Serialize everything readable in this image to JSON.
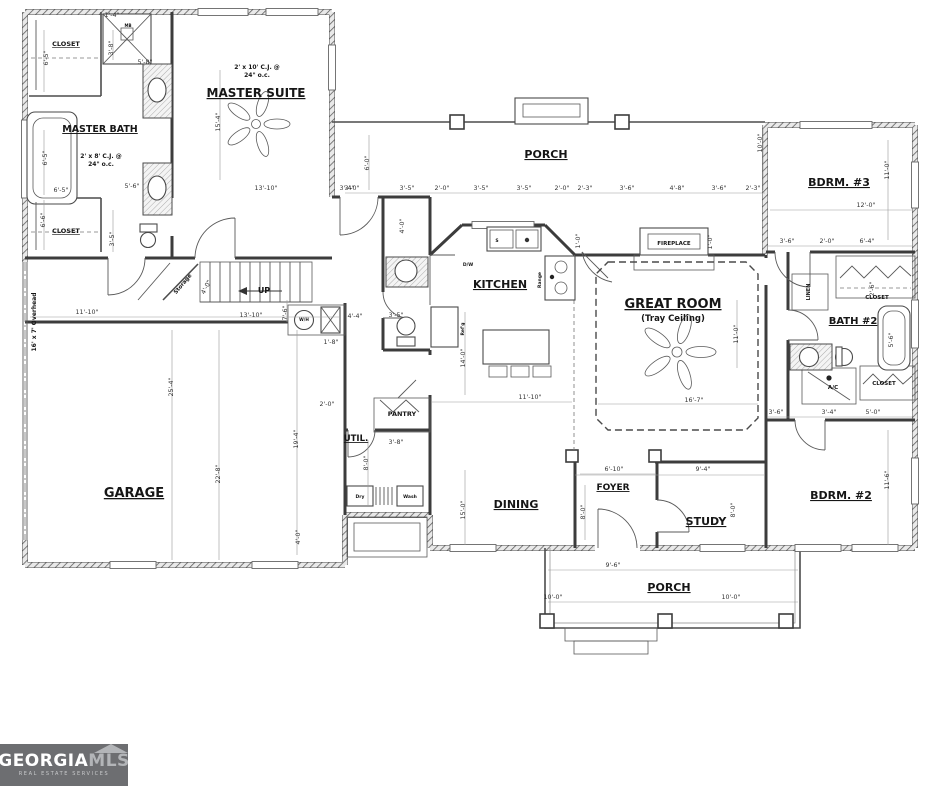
{
  "logo": {
    "brand_bold": "GEORGIA",
    "brand_light": "MLS",
    "tagline": "REAL ESTATE SERVICES",
    "bg_color": "#6d6e71"
  },
  "plan": {
    "ink_color": "#3c3c3c",
    "room_labels": [
      {
        "id": "master-bath",
        "label": "MASTER BATH",
        "x": 100,
        "y": 132,
        "fs": 9.5,
        "ul": true
      },
      {
        "id": "master-suite",
        "label": "MASTER SUITE",
        "x": 256,
        "y": 97,
        "fs": 12,
        "ul": true
      },
      {
        "id": "closet-master-top",
        "label": "CLOSET",
        "x": 66,
        "y": 46,
        "fs": 6.5,
        "ul": true
      },
      {
        "id": "closet-master-bottom",
        "label": "CLOSET",
        "x": 66,
        "y": 233,
        "fs": 6.5,
        "ul": true
      },
      {
        "id": "porch-top",
        "label": "PORCH",
        "x": 546,
        "y": 158,
        "fs": 11,
        "ul": true
      },
      {
        "id": "kitchen",
        "label": "KITCHEN",
        "x": 500,
        "y": 288,
        "fs": 11,
        "ul": true
      },
      {
        "id": "great-room",
        "label": "GREAT ROOM",
        "x": 673,
        "y": 308,
        "fs": 13,
        "ul": true
      },
      {
        "id": "great-room-sub",
        "label": "(Tray Ceiling)",
        "x": 673,
        "y": 321,
        "fs": 8.5
      },
      {
        "id": "fireplace",
        "label": "FIREPLACE",
        "x": 674,
        "y": 245,
        "fs": 5.5
      },
      {
        "id": "bdrm3",
        "label": "BDRM. #3",
        "x": 839,
        "y": 186,
        "fs": 11,
        "ul": true
      },
      {
        "id": "bath2",
        "label": "BATH #2",
        "x": 853,
        "y": 324,
        "fs": 10,
        "ul": true
      },
      {
        "id": "linen",
        "label": "LINEN",
        "x": 810,
        "y": 292,
        "fs": 5,
        "rot": -90
      },
      {
        "id": "closet-bath2",
        "label": "CLOSET",
        "x": 877,
        "y": 299,
        "fs": 5.5
      },
      {
        "id": "closet-bdrm2",
        "label": "CLOSET",
        "x": 884,
        "y": 385,
        "fs": 5.5
      },
      {
        "id": "ac-closet",
        "label": "A/C",
        "x": 833,
        "y": 389,
        "fs": 5.5
      },
      {
        "id": "bdrm2",
        "label": "BDRM. #2",
        "x": 841,
        "y": 499,
        "fs": 11,
        "ul": true
      },
      {
        "id": "study",
        "label": "STUDY",
        "x": 706,
        "y": 525,
        "fs": 11,
        "ul": true
      },
      {
        "id": "foyer",
        "label": "FOYER",
        "x": 613,
        "y": 490,
        "fs": 9,
        "ul": true
      },
      {
        "id": "dining",
        "label": "DINING",
        "x": 516,
        "y": 508,
        "fs": 11,
        "ul": true
      },
      {
        "id": "util",
        "label": "UTIL.",
        "x": 356,
        "y": 441,
        "fs": 8.5,
        "ul": true
      },
      {
        "id": "pantry",
        "label": "PANTRY",
        "x": 402,
        "y": 416,
        "fs": 6.5
      },
      {
        "id": "garage",
        "label": "GARAGE",
        "x": 134,
        "y": 497,
        "fs": 13,
        "ul": true
      },
      {
        "id": "porch-bottom",
        "label": "PORCH",
        "x": 669,
        "y": 591,
        "fs": 11,
        "ul": true
      },
      {
        "id": "up",
        "label": "UP",
        "x": 264,
        "y": 293,
        "fs": 8
      },
      {
        "id": "water-heater",
        "label": "W/H",
        "x": 304,
        "y": 321,
        "fs": 4.2
      },
      {
        "id": "storage",
        "label": "Storage",
        "x": 184,
        "y": 285,
        "fs": 5.5,
        "rot": -50
      },
      {
        "id": "dryer",
        "label": "Dry",
        "x": 360,
        "y": 498,
        "fs": 4.5
      },
      {
        "id": "washer",
        "label": "Wash",
        "x": 410,
        "y": 498,
        "fs": 4.5
      },
      {
        "id": "dishwasher",
        "label": "D/W",
        "x": 468,
        "y": 266,
        "fs": 4.5
      },
      {
        "id": "range",
        "label": "Range",
        "x": 541,
        "y": 280,
        "fs": 4.5,
        "rot": -90
      },
      {
        "id": "refrigerator",
        "label": "Ref'g",
        "x": 464,
        "y": 329,
        "fs": 4.5,
        "rot": -90
      },
      {
        "id": "sink",
        "label": "S",
        "x": 497,
        "y": 242,
        "fs": 4.5
      },
      {
        "id": "shower-head",
        "label": "MB",
        "x": 128,
        "y": 27,
        "fs": 4
      },
      {
        "id": "overhead-door",
        "label": "16' x 7' Overhead",
        "x": 36,
        "y": 322,
        "fs": 6,
        "rot": -90
      },
      {
        "id": "cj-note-suite-1",
        "label": "2' x 10' C.J. @",
        "x": 257,
        "y": 69,
        "fs": 6
      },
      {
        "id": "cj-note-suite-2",
        "label": "24\" o.c.",
        "x": 257,
        "y": 77,
        "fs": 6
      },
      {
        "id": "cj-note-bath-1",
        "label": "2' x 8' C.J. @",
        "x": 101,
        "y": 158,
        "fs": 6
      },
      {
        "id": "cj-note-bath-2",
        "label": "24\" o.c.",
        "x": 101,
        "y": 166,
        "fs": 6
      }
    ],
    "annotations": [
      {
        "text": "3'-0\"",
        "x": 352,
        "y": 190
      },
      {
        "text": "3'-5\"",
        "x": 407,
        "y": 190
      },
      {
        "text": "2'-0\"",
        "x": 442,
        "y": 190
      },
      {
        "text": "3'-5\"",
        "x": 481,
        "y": 190
      },
      {
        "text": "3'-5\"",
        "x": 524,
        "y": 190
      },
      {
        "text": "2'-0\"",
        "x": 562,
        "y": 190
      },
      {
        "text": "2'-3\"",
        "x": 585,
        "y": 190
      },
      {
        "text": "3'-6\"",
        "x": 627,
        "y": 190
      },
      {
        "text": "4'-8\"",
        "x": 677,
        "y": 190
      },
      {
        "text": "3'-6\"",
        "x": 719,
        "y": 190
      },
      {
        "text": "2'-3\"",
        "x": 753,
        "y": 190
      },
      {
        "text": "6'-0\"",
        "x": 369,
        "y": 163,
        "rot": -90
      },
      {
        "text": "10'-0\"",
        "x": 762,
        "y": 143,
        "rot": -90
      },
      {
        "text": "12'-0\"",
        "x": 866,
        "y": 207
      },
      {
        "text": "11'-0\"",
        "x": 889,
        "y": 170,
        "rot": -90
      },
      {
        "text": "3'-6\"",
        "x": 787,
        "y": 243
      },
      {
        "text": "2'-0\"",
        "x": 827,
        "y": 243
      },
      {
        "text": "6'-4\"",
        "x": 867,
        "y": 243
      },
      {
        "text": "2'-6\"",
        "x": 874,
        "y": 289,
        "rot": -90
      },
      {
        "text": "5'-6\"",
        "x": 893,
        "y": 340,
        "rot": -90
      },
      {
        "text": "3'-6\"",
        "x": 776,
        "y": 414
      },
      {
        "text": "3'-4\"",
        "x": 829,
        "y": 414
      },
      {
        "text": "5'-0\"",
        "x": 873,
        "y": 414
      },
      {
        "text": "11'-6\"",
        "x": 889,
        "y": 480,
        "rot": -90
      },
      {
        "text": "6'-10\"",
        "x": 614,
        "y": 471
      },
      {
        "text": "9'-4\"",
        "x": 703,
        "y": 471
      },
      {
        "text": "8'-0\"",
        "x": 585,
        "y": 512,
        "rot": -90
      },
      {
        "text": "8'-0\"",
        "x": 735,
        "y": 510,
        "rot": -90
      },
      {
        "text": "9'-6\"",
        "x": 613,
        "y": 567
      },
      {
        "text": "10'-0\"",
        "x": 553,
        "y": 599
      },
      {
        "text": "10'-0\"",
        "x": 731,
        "y": 599
      },
      {
        "text": "16'-7\"",
        "x": 694,
        "y": 402
      },
      {
        "text": "11'-0\"",
        "x": 738,
        "y": 334,
        "rot": -90
      },
      {
        "text": "11'-10\"",
        "x": 530,
        "y": 399
      },
      {
        "text": "14'-0\"",
        "x": 465,
        "y": 358,
        "rot": -90
      },
      {
        "text": "4'-0\"",
        "x": 404,
        "y": 226,
        "rot": -90
      },
      {
        "text": "3'-5\"",
        "x": 396,
        "y": 317
      },
      {
        "text": "2'-0\"",
        "x": 327,
        "y": 406
      },
      {
        "text": "4'-4\"",
        "x": 355,
        "y": 318
      },
      {
        "text": "1'-8\"",
        "x": 331,
        "y": 344
      },
      {
        "text": "13'-10\"",
        "x": 251,
        "y": 317
      },
      {
        "text": "7'-6\"",
        "x": 287,
        "y": 313,
        "rot": -90
      },
      {
        "text": "11'-10\"",
        "x": 87,
        "y": 314
      },
      {
        "text": "4'-0\"",
        "x": 208,
        "y": 288,
        "rot": -62
      },
      {
        "text": "25'-4\"",
        "x": 173,
        "y": 387,
        "rot": -90
      },
      {
        "text": "22'-8\"",
        "x": 220,
        "y": 474,
        "rot": -90
      },
      {
        "text": "19'-4\"",
        "x": 298,
        "y": 439,
        "rot": -90
      },
      {
        "text": "4'-0\"",
        "x": 300,
        "y": 537,
        "rot": -90
      },
      {
        "text": "3'-8\"",
        "x": 396,
        "y": 444
      },
      {
        "text": "8'-0\"",
        "x": 368,
        "y": 463,
        "rot": -90
      },
      {
        "text": "15'-0\"",
        "x": 465,
        "y": 510,
        "rot": -90
      },
      {
        "text": "15'-4\"",
        "x": 220,
        "y": 122,
        "rot": -90
      },
      {
        "text": "13'-10\"",
        "x": 266,
        "y": 190
      },
      {
        "text": "3'-4\"",
        "x": 347,
        "y": 190
      },
      {
        "text": "6'-5\"",
        "x": 48,
        "y": 58,
        "rot": -90
      },
      {
        "text": "6'-5\"",
        "x": 47,
        "y": 158,
        "rot": -90
      },
      {
        "text": "6'-5\"",
        "x": 61,
        "y": 192
      },
      {
        "text": "6'-6\"",
        "x": 45,
        "y": 220,
        "rot": -90
      },
      {
        "text": "3'-5\"",
        "x": 114,
        "y": 239,
        "rot": -90
      },
      {
        "text": "5'-6\"",
        "x": 132,
        "y": 188
      },
      {
        "text": "3'-8\"",
        "x": 113,
        "y": 48,
        "rot": -90
      },
      {
        "text": "5'-8\"",
        "x": 145,
        "y": 64
      },
      {
        "text": "1'-4\"",
        "x": 112,
        "y": 17
      },
      {
        "text": "1'-0\"",
        "x": 712,
        "y": 242,
        "rot": -90
      },
      {
        "text": "1'-0\"",
        "x": 580,
        "y": 241,
        "rot": -90
      }
    ]
  }
}
